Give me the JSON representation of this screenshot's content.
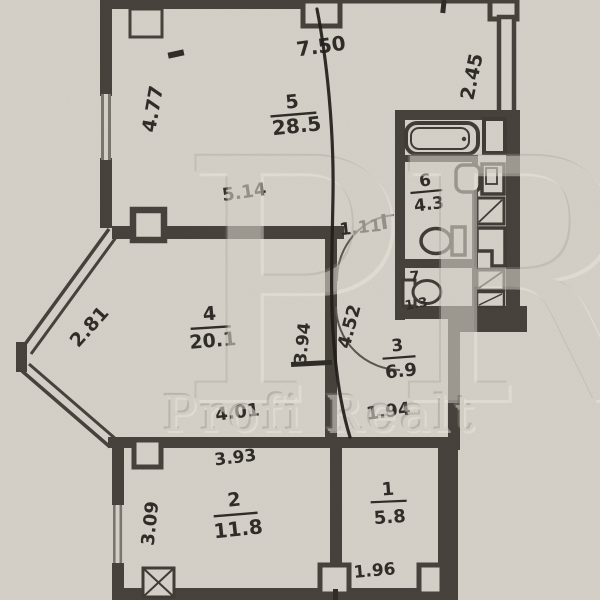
{
  "watermark": {
    "initials": "PR",
    "brand": "Profi Realt"
  },
  "rooms": [
    {
      "number": "1",
      "area": "5.8"
    },
    {
      "number": "2",
      "area": "11.8"
    },
    {
      "number": "3",
      "area": "6.9"
    },
    {
      "number": "4",
      "area": "20.1"
    },
    {
      "number": "5",
      "area": "28.5"
    },
    {
      "number": "6",
      "area": "4.3"
    },
    {
      "number": "7",
      "area": "1.3"
    }
  ],
  "dimensions": {
    "top_width": "7.50",
    "right_upper_wall": "2.45",
    "left_upper_wall": "4.77",
    "room5_bottom": "5.14",
    "vestibule_width": "1.11",
    "corridor_left": "3.94",
    "corridor_right": "4.52",
    "bay_diagonal": "2.81",
    "room4_bottom": "4.01",
    "room3_bottom": "1.94",
    "room2_top": "3.93",
    "left_lower_wall": "3.09",
    "room1_bottom": "1.96"
  },
  "colors": {
    "paper": "#d6d2c9",
    "wall": "#45403a",
    "ink": "#2e2a26",
    "pen": "#1e1b18",
    "watermark": "#c9c5bc"
  }
}
